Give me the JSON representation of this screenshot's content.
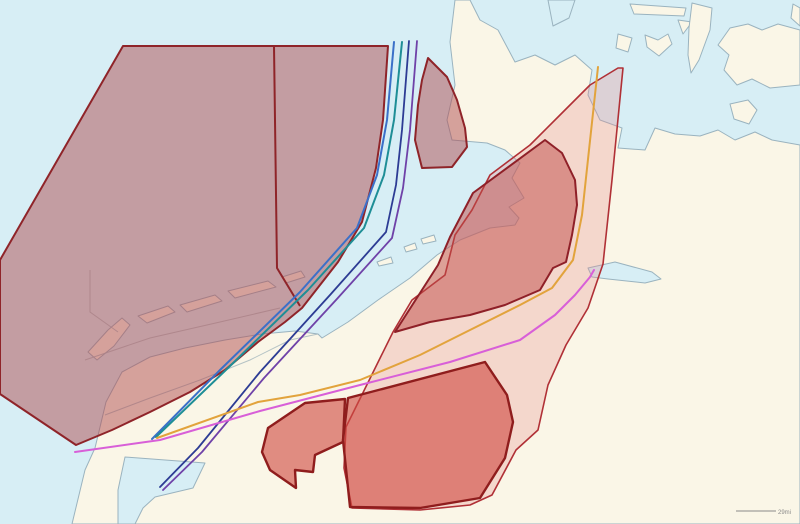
{
  "map": {
    "scale": {
      "label": "29mi"
    },
    "colors": {
      "water": "#d7eef5",
      "land": "#faf6e7",
      "coast": "#9ab3bf",
      "detail": "#a4b6bd",
      "zone_strong_fill": "#b04b50",
      "zone_strong_stroke": "#8f2429",
      "zone_pale_fill": "#e89090",
      "zone_pale_stroke": "#b03036",
      "zone_mid_fill": "#c04b48",
      "zone_mid_stroke": "#8f2028",
      "zone_hot_fill": "#d04a42",
      "zone_hot_stroke": "#8f1d1d",
      "line_blue": "#3b70c8",
      "line_teal": "#1e8e96",
      "line_navy": "#2d3c94",
      "line_purple": "#6f42a8",
      "line_orange": "#e2a33c",
      "line_magenta": "#d85fd8",
      "scalebar": "#8a8a8a"
    },
    "zones": {
      "northwest_zone": "restricted-zone-northwest",
      "north_small_zone": "restricted-zone-north-small",
      "pale_corridor_zone": "restricted-zone-pale-corridor",
      "central_zone": "restricted-zone-central",
      "south_zone": "restricted-zone-south"
    },
    "routes": {
      "blue": "route-line-blue",
      "teal": "route-line-teal",
      "navy": "route-line-navy",
      "purple": "route-line-purple",
      "orange": "route-line-orange",
      "magenta": "route-line-magenta"
    }
  }
}
